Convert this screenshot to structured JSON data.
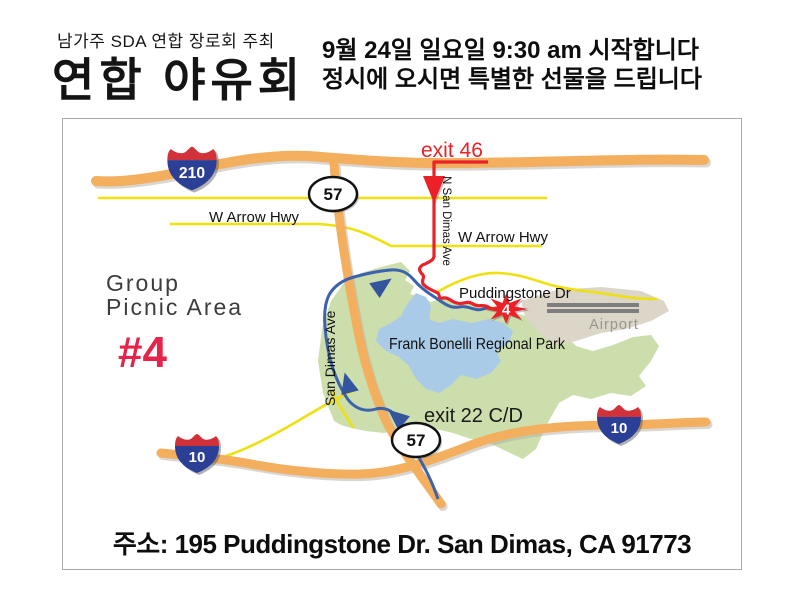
{
  "header": {
    "organizer": "남가주 SDA 연합 장로회 주최",
    "title": "연합 야유회",
    "line1": "9월 24일 일요일 9:30 am 시작합니다",
    "line2": "정시에 오시면 특별한 선물을 드립니다"
  },
  "map": {
    "labels": {
      "exit46": "exit 46",
      "n_san_dimas_ave": "N San Dimas Ave",
      "w_arrow_hwy_left": "W Arrow Hwy",
      "w_arrow_hwy_right": "W Arrow Hwy",
      "puddingstone_dr": "Puddingstone Dr",
      "airport": "Airport",
      "park": "Frank Bonelli Regional Park",
      "group_picnic_line1": "Group",
      "group_picnic_line2": "Picnic Area",
      "group_picnic_number": "#4",
      "san_dimas_ave": "San Dimas Ave",
      "exit22": "exit 22 C/D",
      "marker_number": "4"
    },
    "shields": {
      "interstate_210": "210",
      "route_57": "57",
      "interstate_10": "10"
    },
    "colors": {
      "freeway_orange": "#F3AE5E",
      "highway_yellow": "#EFE00F",
      "route_red": "#EC2027",
      "route_blue": "#3B63AE",
      "park_green": "#CBDEAC",
      "lake_blue": "#A9CBE7",
      "airport_beige": "#DCD6C9",
      "runway_gray": "#7E7E7E",
      "interstate_red": "#D13239",
      "interstate_blue": "#2C3F96",
      "picnic_number_red": "#E5234B"
    }
  },
  "footer": {
    "address": "주소: 195 Puddingstone Dr. San Dimas, CA  91773"
  }
}
